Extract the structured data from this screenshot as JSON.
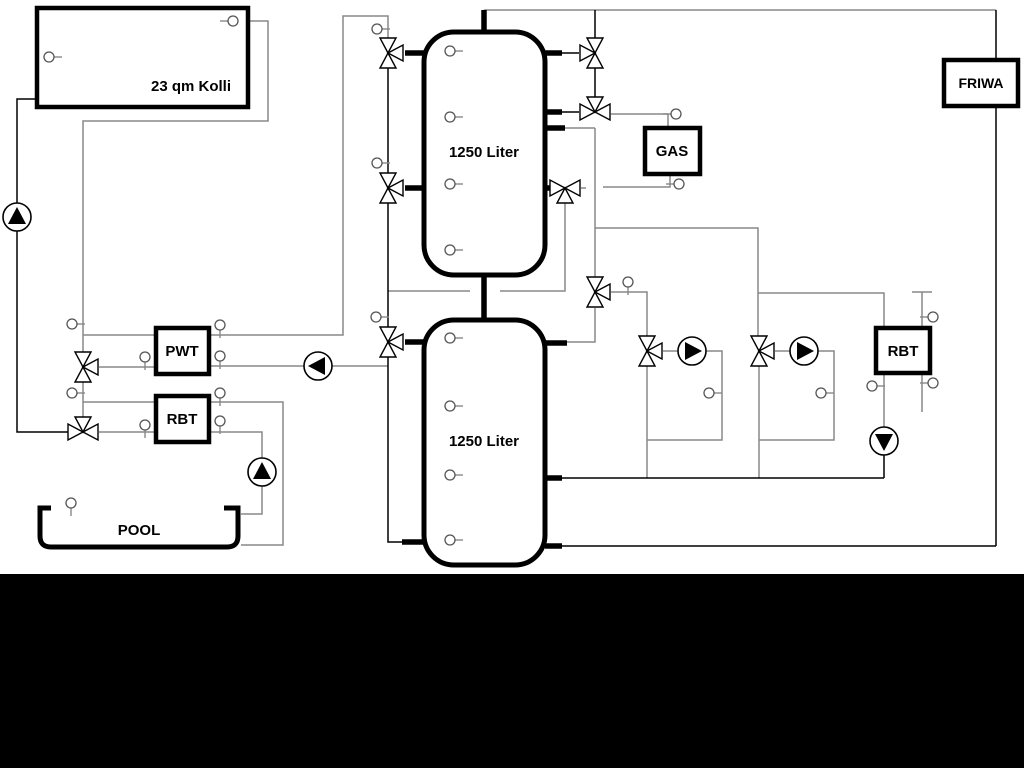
{
  "diagram_type": "heating-system-hydraulic-schematic",
  "labels": {
    "collector": "23 qm Kolli",
    "tank1": "1250 Liter",
    "tank2": "1250 Liter",
    "gas": "GAS",
    "friwa": "FRIWA",
    "pwt": "PWT",
    "rbt_left": "RBT",
    "rbt_right": "RBT",
    "pool": "POOL"
  },
  "colors": {
    "background": "#ffffff",
    "primary_line": "#000000",
    "secondary_line": "#888888",
    "bottom_band": "#000000",
    "symbol_fill": "#ffffff"
  },
  "symbols": {
    "pumps": 6,
    "three_way_valves": 11,
    "temperature_sensors": 30
  }
}
